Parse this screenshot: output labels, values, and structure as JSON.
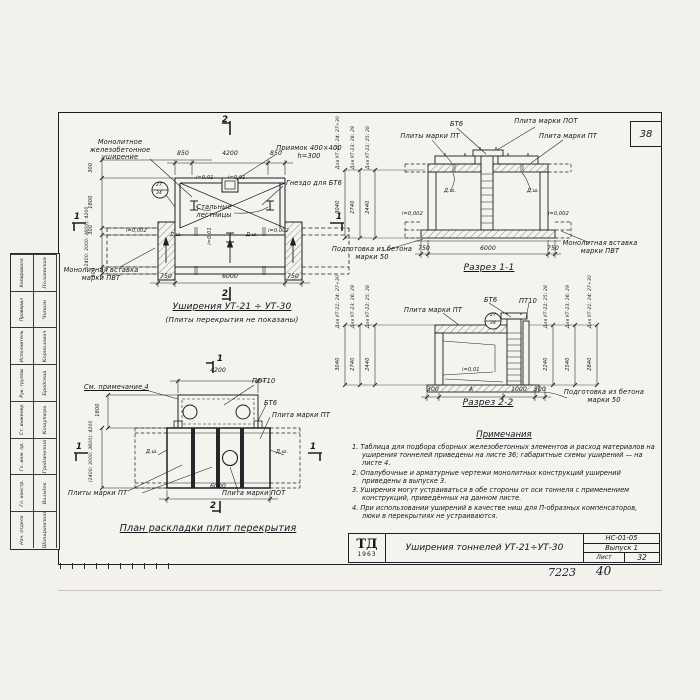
{
  "sheet": {
    "corner_number": "38",
    "footer_left": "7223",
    "footer_right": "40"
  },
  "title_block": {
    "logo_top": "ТД",
    "logo_year": "1963",
    "title": "Уширения тоннелей УТ-21÷УТ-30",
    "code": "НС-01-05",
    "issue": "Выпуск 1",
    "sheet_label": "Лист",
    "sheet_number": "32"
  },
  "stamp": {
    "rows": [
      {
        "role": "Нач. отдела",
        "name": "Шапиранский"
      },
      {
        "role": "Гл. констр.",
        "name": "Вальдок"
      },
      {
        "role": "Гл. инж. пр.",
        "name": "Гродзенский"
      },
      {
        "role": "Ст. инженер",
        "name": "Кошутери"
      },
      {
        "role": "Рук. группы",
        "name": "Бродский"
      },
      {
        "role": "Исполнитель",
        "name": "Корнилович"
      },
      {
        "role": "Проверил",
        "name": "Чипиги"
      },
      {
        "role": "Копировала",
        "name": "Полаевская"
      }
    ]
  },
  "plan_top": {
    "title": "Уширения УТ-21 ÷ УТ-30",
    "subtitle": "(Плиты перекрытия не показаны)",
    "label_monolith": "Монолитное железобетонное уширение",
    "label_pit": "Приямок 400×400 h=300",
    "label_socket": "Гнездо для БТ6",
    "label_insert": "Монолитная вставка марки ПВТ",
    "label_ladders": "Стальные лестницы",
    "slope_pit_left": "i=0,01",
    "slope_pit_right": "i=0,01",
    "slope_center": "i=0,01",
    "slope_left": "i=0,002",
    "slope_right": "i=0,002",
    "joint_left": "Д.ш.",
    "joint_right": "Д.ш.",
    "dims_top": [
      "850",
      "4200",
      "850"
    ],
    "dims_bottom": [
      "750",
      "6000",
      "750"
    ],
    "dims_left": [
      "300",
      "1800",
      "300",
      "(2400; 3000; 3600); 4200",
      "300"
    ],
    "detail_circle": {
      "top": "27",
      "bottom": "34"
    },
    "mark_1": "1",
    "mark_2": "2"
  },
  "section1": {
    "title": "Разрез 1-1",
    "label_bt6": "БТ6",
    "label_pot": "Плита марки ПОТ",
    "label_pt_left": "Плиты марки ПТ",
    "label_pt_right": "Плита марки ПТ",
    "label_prep": "Подготовка из бетона марки 50",
    "label_insert": "Монолитная вставка марки ПВТ",
    "joint_left": "Д.ш.",
    "joint_right": "Д.ш.",
    "slope_left": "i=0,002",
    "slope_right": "i=0,002",
    "dims_bottom": [
      "750",
      "6000",
      "750"
    ],
    "vdims": [
      {
        "label": "Для УТ-21; 24; 27÷30",
        "value": "3040"
      },
      {
        "label": "Для УТ-23; 26; 29",
        "value": "2740"
      },
      {
        "label": "Для УТ-22; 25; 28",
        "value": "2440"
      }
    ]
  },
  "section2": {
    "title": "Разрез 2-2",
    "label_pt": "Плита марки ПТ",
    "label_bt6": "БТ6",
    "label_pt10": "ПТ10",
    "label_prep": "Подготовка из бетона марки 50",
    "slope": "i=0,01",
    "dims_bottom": [
      "300",
      "А",
      "1000",
      "300"
    ],
    "detail_circle": {
      "top": "27",
      "bottom": "34"
    },
    "vdims_left": [
      {
        "label": "Для УТ-21; 24; 27÷30",
        "value": "3040"
      },
      {
        "label": "Для УТ-23; 26; 29",
        "value": "2740"
      },
      {
        "label": "Для УТ-22; 25; 28",
        "value": "2440"
      }
    ],
    "vdims_right": [
      {
        "label": "Для УТ-22; 25; 28",
        "value": "2240"
      },
      {
        "label": "Для УТ-23; 26; 29",
        "value": "2540"
      },
      {
        "label": "Для УТ-21; 24; 27÷30",
        "value": "2840"
      }
    ]
  },
  "plan_bottom": {
    "title": "План раскладки плит перекрытия",
    "label_note": "См. примечание 4",
    "label_pot10": "ПОТ10",
    "label_bt6": "БТ6",
    "label_pt": "Плита марки ПТ",
    "label_pt_plural": "Плиты марки ПТ",
    "label_pot": "Плита марки ПОТ",
    "joint_left": "Д.ш.",
    "joint_right": "Д.ш.",
    "dim_top": "4200",
    "dim_bottom": "6000",
    "dims_left": [
      "1800",
      "(2400; 3000; 3600); 4200"
    ],
    "mark_1": "1",
    "mark_2": "2"
  },
  "notes": {
    "heading": "Примечания",
    "items": [
      "1. Таблица для подбора сборных железобетонных элементов и расход материалов на уширения тоннелей приведены на листе 36; габаритные схемы уширений — на листе 4.",
      "2. Опалубочные и арматурные чертежи монолитных конструкций уширений приведены в выпуске 3.",
      "3. Уширения могут устраиваться в обе стороны от оси тоннеля с применением конструкций, приведённых на данном листе.",
      "4. При использовании уширений в качестве ниш для П-образных компенсаторов, люки в перекрытиях не устраиваются."
    ]
  }
}
